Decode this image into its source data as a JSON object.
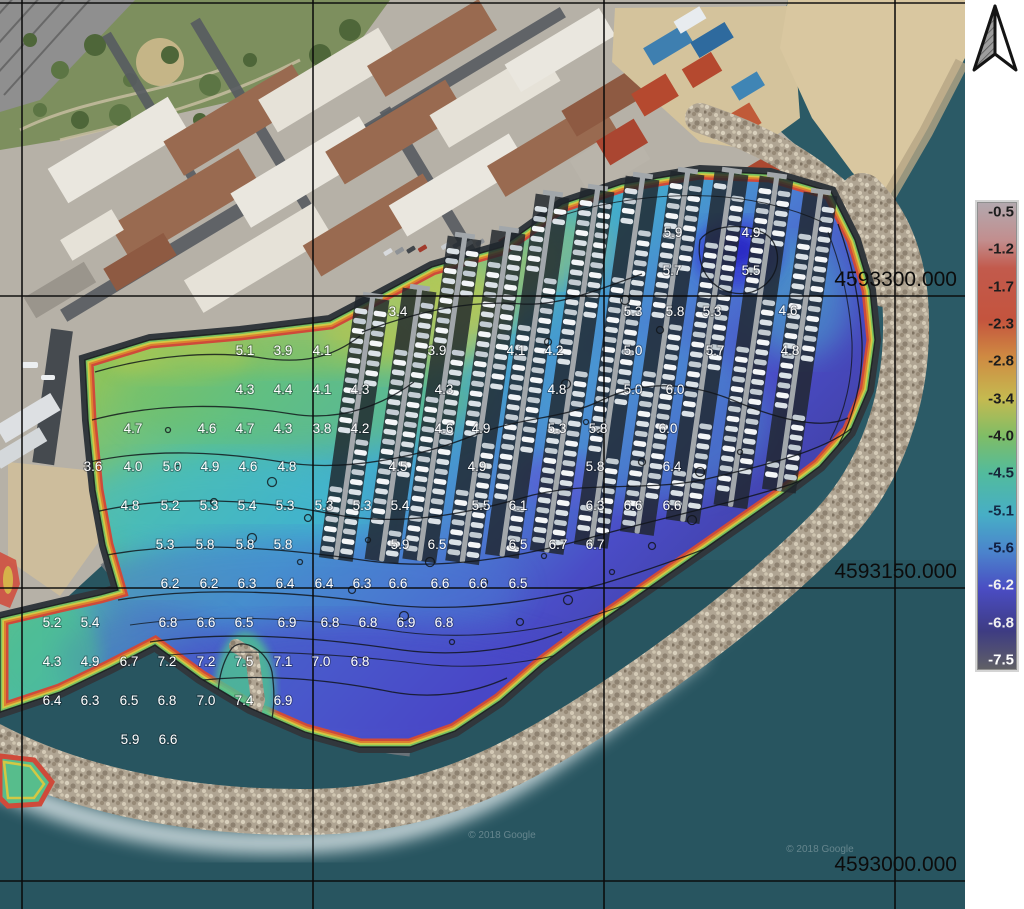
{
  "map": {
    "grid": {
      "vertical_lines_x": [
        22,
        313,
        604,
        895
      ],
      "horizontal_lines_y": [
        3,
        296,
        588,
        881
      ],
      "northing_labels": [
        {
          "text": "4593300.000",
          "line_y": 296
        },
        {
          "text": "4593150.000",
          "line_y": 588
        },
        {
          "text": "4593000.000",
          "line_y": 881
        }
      ]
    },
    "watermarks": [
      {
        "text": "© 2018 Google",
        "x": 502,
        "y": 838
      },
      {
        "text": "© 2018 Google",
        "x": 820,
        "y": 852
      }
    ],
    "depth_labels": [
      {
        "x": 673,
        "y": 232,
        "t": "5.9"
      },
      {
        "x": 751,
        "y": 232,
        "t": "4.9"
      },
      {
        "x": 672,
        "y": 270,
        "t": "5.7"
      },
      {
        "x": 751,
        "y": 270,
        "t": "5.5"
      },
      {
        "x": 398,
        "y": 311,
        "t": "3.4"
      },
      {
        "x": 633,
        "y": 311,
        "t": "5.3"
      },
      {
        "x": 675,
        "y": 311,
        "t": "5.8"
      },
      {
        "x": 712,
        "y": 311,
        "t": "5.3"
      },
      {
        "x": 788,
        "y": 310,
        "t": "4.6"
      },
      {
        "x": 245,
        "y": 350,
        "t": "5.1"
      },
      {
        "x": 283,
        "y": 350,
        "t": "3.9"
      },
      {
        "x": 322,
        "y": 350,
        "t": "4.1"
      },
      {
        "x": 437,
        "y": 350,
        "t": "3.9"
      },
      {
        "x": 516,
        "y": 350,
        "t": "4.1"
      },
      {
        "x": 554,
        "y": 350,
        "t": "4.2"
      },
      {
        "x": 633,
        "y": 350,
        "t": "5.0"
      },
      {
        "x": 715,
        "y": 350,
        "t": "5.7"
      },
      {
        "x": 790,
        "y": 350,
        "t": "4.8"
      },
      {
        "x": 245,
        "y": 389,
        "t": "4.3"
      },
      {
        "x": 283,
        "y": 389,
        "t": "4.4"
      },
      {
        "x": 322,
        "y": 389,
        "t": "4.1"
      },
      {
        "x": 360,
        "y": 389,
        "t": "4.3"
      },
      {
        "x": 444,
        "y": 389,
        "t": "4.3"
      },
      {
        "x": 557,
        "y": 389,
        "t": "4.8"
      },
      {
        "x": 633,
        "y": 389,
        "t": "5.0"
      },
      {
        "x": 675,
        "y": 389,
        "t": "6.0"
      },
      {
        "x": 133,
        "y": 428,
        "t": "4.7"
      },
      {
        "x": 207,
        "y": 428,
        "t": "4.6"
      },
      {
        "x": 245,
        "y": 428,
        "t": "4.7"
      },
      {
        "x": 283,
        "y": 428,
        "t": "4.3"
      },
      {
        "x": 322,
        "y": 428,
        "t": "3.8"
      },
      {
        "x": 360,
        "y": 428,
        "t": "4.2"
      },
      {
        "x": 444,
        "y": 428,
        "t": "4.6"
      },
      {
        "x": 481,
        "y": 428,
        "t": "4.9"
      },
      {
        "x": 557,
        "y": 428,
        "t": "5.3"
      },
      {
        "x": 598,
        "y": 428,
        "t": "5.8"
      },
      {
        "x": 668,
        "y": 428,
        "t": "6.0"
      },
      {
        "x": 93,
        "y": 466,
        "t": "3.6"
      },
      {
        "x": 133,
        "y": 466,
        "t": "4.0"
      },
      {
        "x": 172,
        "y": 466,
        "t": "5.0"
      },
      {
        "x": 210,
        "y": 466,
        "t": "4.9"
      },
      {
        "x": 248,
        "y": 466,
        "t": "4.6"
      },
      {
        "x": 287,
        "y": 466,
        "t": "4.8"
      },
      {
        "x": 398,
        "y": 466,
        "t": "4.5"
      },
      {
        "x": 477,
        "y": 466,
        "t": "4.9"
      },
      {
        "x": 595,
        "y": 466,
        "t": "5.8"
      },
      {
        "x": 672,
        "y": 466,
        "t": "6.4"
      },
      {
        "x": 130,
        "y": 505,
        "t": "4.8"
      },
      {
        "x": 170,
        "y": 505,
        "t": "5.2"
      },
      {
        "x": 209,
        "y": 505,
        "t": "5.3"
      },
      {
        "x": 247,
        "y": 505,
        "t": "5.4"
      },
      {
        "x": 285,
        "y": 505,
        "t": "5.3"
      },
      {
        "x": 324,
        "y": 505,
        "t": "5.3"
      },
      {
        "x": 362,
        "y": 505,
        "t": "5.3"
      },
      {
        "x": 400,
        "y": 505,
        "t": "5.4"
      },
      {
        "x": 481,
        "y": 505,
        "t": "5.5"
      },
      {
        "x": 518,
        "y": 505,
        "t": "6.1"
      },
      {
        "x": 595,
        "y": 505,
        "t": "6.3"
      },
      {
        "x": 633,
        "y": 505,
        "t": "6.6"
      },
      {
        "x": 672,
        "y": 505,
        "t": "6.6"
      },
      {
        "x": 165,
        "y": 544,
        "t": "5.3"
      },
      {
        "x": 205,
        "y": 544,
        "t": "5.8"
      },
      {
        "x": 245,
        "y": 544,
        "t": "5.8"
      },
      {
        "x": 283,
        "y": 544,
        "t": "5.8"
      },
      {
        "x": 400,
        "y": 544,
        "t": "5.9"
      },
      {
        "x": 437,
        "y": 544,
        "t": "6.5"
      },
      {
        "x": 518,
        "y": 544,
        "t": "6.5"
      },
      {
        "x": 558,
        "y": 544,
        "t": "6.7"
      },
      {
        "x": 595,
        "y": 544,
        "t": "6.7"
      },
      {
        "x": 170,
        "y": 583,
        "t": "6.2"
      },
      {
        "x": 209,
        "y": 583,
        "t": "6.2"
      },
      {
        "x": 247,
        "y": 583,
        "t": "6.3"
      },
      {
        "x": 285,
        "y": 583,
        "t": "6.4"
      },
      {
        "x": 324,
        "y": 583,
        "t": "6.4"
      },
      {
        "x": 362,
        "y": 583,
        "t": "6.3"
      },
      {
        "x": 398,
        "y": 583,
        "t": "6.6"
      },
      {
        "x": 440,
        "y": 583,
        "t": "6.6"
      },
      {
        "x": 478,
        "y": 583,
        "t": "6.6"
      },
      {
        "x": 518,
        "y": 583,
        "t": "6.5"
      },
      {
        "x": 52,
        "y": 622,
        "t": "5.2"
      },
      {
        "x": 90,
        "y": 622,
        "t": "5.4"
      },
      {
        "x": 168,
        "y": 622,
        "t": "6.8"
      },
      {
        "x": 206,
        "y": 622,
        "t": "6.6"
      },
      {
        "x": 244,
        "y": 622,
        "t": "6.5"
      },
      {
        "x": 287,
        "y": 622,
        "t": "6.9"
      },
      {
        "x": 330,
        "y": 622,
        "t": "6.8"
      },
      {
        "x": 368,
        "y": 622,
        "t": "6.8"
      },
      {
        "x": 406,
        "y": 622,
        "t": "6.9"
      },
      {
        "x": 444,
        "y": 622,
        "t": "6.8"
      },
      {
        "x": 52,
        "y": 661,
        "t": "4.3"
      },
      {
        "x": 90,
        "y": 661,
        "t": "4.9"
      },
      {
        "x": 129,
        "y": 661,
        "t": "6.7"
      },
      {
        "x": 167,
        "y": 661,
        "t": "7.2"
      },
      {
        "x": 206,
        "y": 661,
        "t": "7.2"
      },
      {
        "x": 244,
        "y": 661,
        "t": "7.5"
      },
      {
        "x": 283,
        "y": 661,
        "t": "7.1"
      },
      {
        "x": 321,
        "y": 661,
        "t": "7.0"
      },
      {
        "x": 360,
        "y": 661,
        "t": "6.8"
      },
      {
        "x": 52,
        "y": 700,
        "t": "6.4"
      },
      {
        "x": 90,
        "y": 700,
        "t": "6.3"
      },
      {
        "x": 129,
        "y": 700,
        "t": "6.5"
      },
      {
        "x": 167,
        "y": 700,
        "t": "6.8"
      },
      {
        "x": 206,
        "y": 700,
        "t": "7.0"
      },
      {
        "x": 244,
        "y": 700,
        "t": "7.4"
      },
      {
        "x": 283,
        "y": 700,
        "t": "6.9"
      },
      {
        "x": 130,
        "y": 739,
        "t": "5.9"
      },
      {
        "x": 168,
        "y": 739,
        "t": "6.6"
      }
    ]
  },
  "colorbar": {
    "ticks": [
      {
        "label": "-0.5",
        "color": "#1d1d1d"
      },
      {
        "label": "-1.2",
        "color": "#1d1d1d"
      },
      {
        "label": "-1.7",
        "color": "#1d1d1d"
      },
      {
        "label": "-2.3",
        "color": "#1d1d1d"
      },
      {
        "label": "-2.8",
        "color": "#1d1d1d"
      },
      {
        "label": "-3.4",
        "color": "#1d1d1d"
      },
      {
        "label": "-4.0",
        "color": "#1d1d1d"
      },
      {
        "label": "-4.5",
        "color": "#17263a"
      },
      {
        "label": "-5.1",
        "color": "#152a46"
      },
      {
        "label": "-5.6",
        "color": "#122042"
      },
      {
        "label": "-6.2",
        "color": "#f0f0f0"
      },
      {
        "label": "-6.8",
        "color": "#f0f0f0"
      },
      {
        "label": "-7.5",
        "color": "#ffffff"
      }
    ],
    "gradient": [
      {
        "pos": 0,
        "color": "#b3a8ae"
      },
      {
        "pos": 8,
        "color": "#c28e8e"
      },
      {
        "pos": 14,
        "color": "#c25a4c"
      },
      {
        "pos": 25,
        "color": "#c4543e"
      },
      {
        "pos": 33,
        "color": "#cf8a42"
      },
      {
        "pos": 42,
        "color": "#c5ba50"
      },
      {
        "pos": 50,
        "color": "#7fbd66"
      },
      {
        "pos": 58,
        "color": "#52bb9d"
      },
      {
        "pos": 67,
        "color": "#47aec6"
      },
      {
        "pos": 75,
        "color": "#4b83cc"
      },
      {
        "pos": 83,
        "color": "#4a4cc2"
      },
      {
        "pos": 92,
        "color": "#3e3c82"
      },
      {
        "pos": 100,
        "color": "#606066"
      }
    ]
  }
}
